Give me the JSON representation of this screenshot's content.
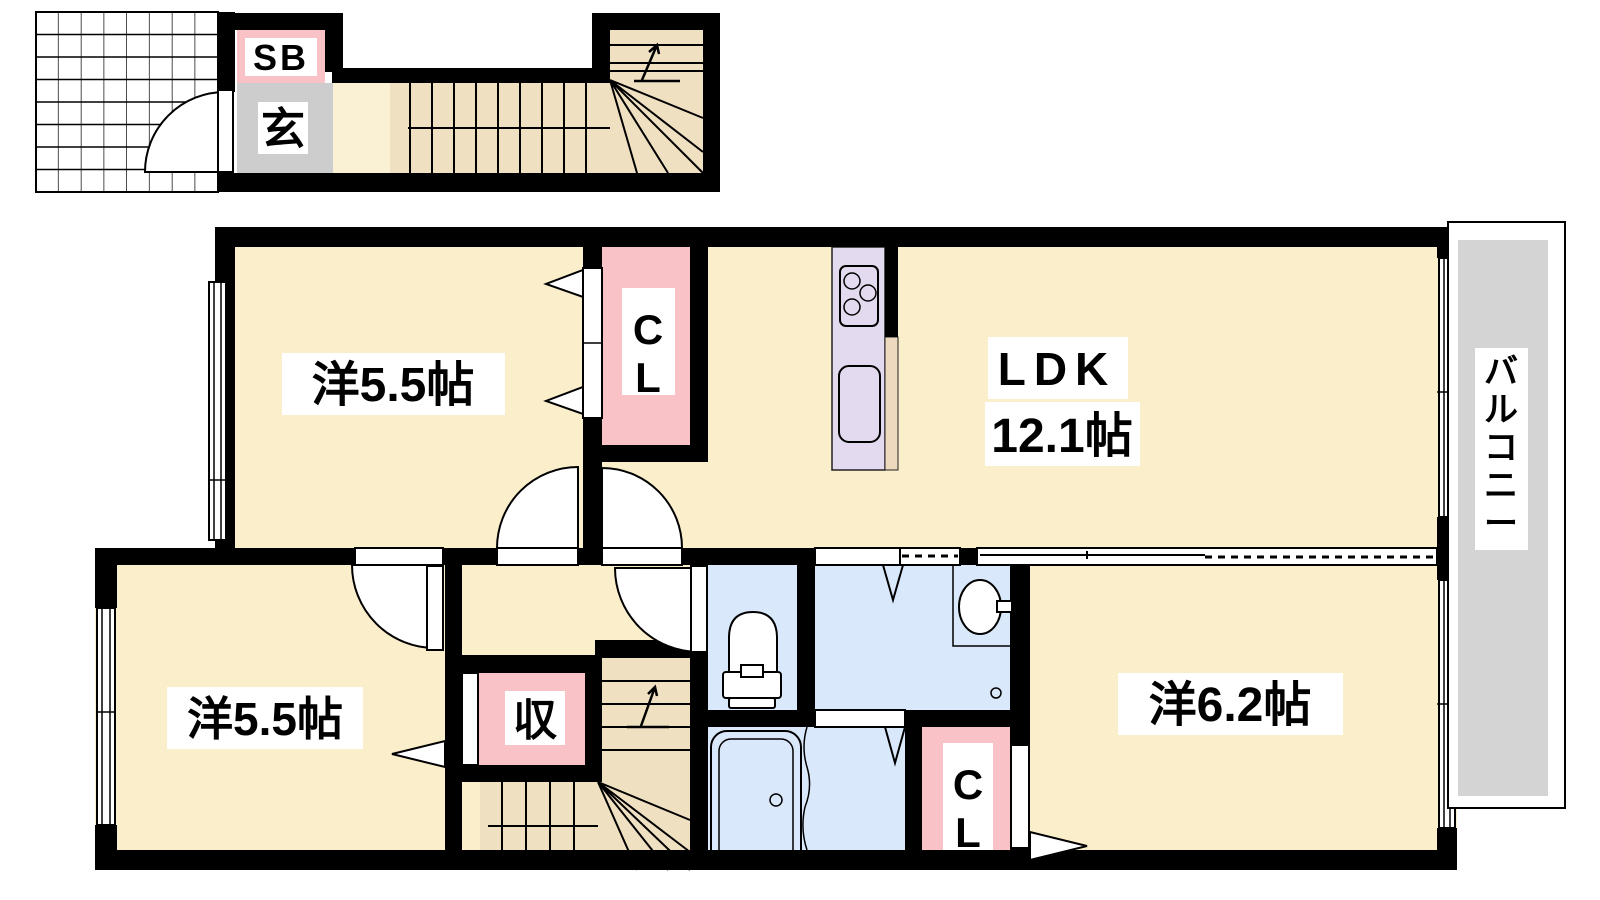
{
  "type": "apartment-floor-plan",
  "palette": {
    "wall": "#000000",
    "room_floor": "#FBEECB",
    "hall_floor": "#FAF0D4",
    "stairs": "#F0E0C2",
    "closet_pink": "#F9C2C6",
    "wet_area_blue": "#D9E8FA",
    "kitchen_lavender": "#E4DAF0",
    "entry_gray": "#CDCDCD",
    "balcony_gray": "#D4D4D4",
    "label_bg": "#FFFFFF"
  },
  "entrance": {
    "shoe_box_label": "SB",
    "genkan_label": "玄"
  },
  "rooms": {
    "bedroom1": {
      "label": "洋5.5帖"
    },
    "bedroom2": {
      "label": "洋5.5帖"
    },
    "bedroom3": {
      "label": "洋6.2帖"
    },
    "ldk": {
      "name": "LDK",
      "size": "12.1帖"
    },
    "storage": {
      "label": "収"
    },
    "closet1": {
      "chars": [
        "C",
        "L"
      ]
    },
    "closet2": {
      "chars": [
        "C",
        "L"
      ]
    },
    "balcony": {
      "label": "バルコニー",
      "chars": [
        "バ",
        "ル",
        "コ",
        "ニ",
        "ー"
      ]
    }
  }
}
